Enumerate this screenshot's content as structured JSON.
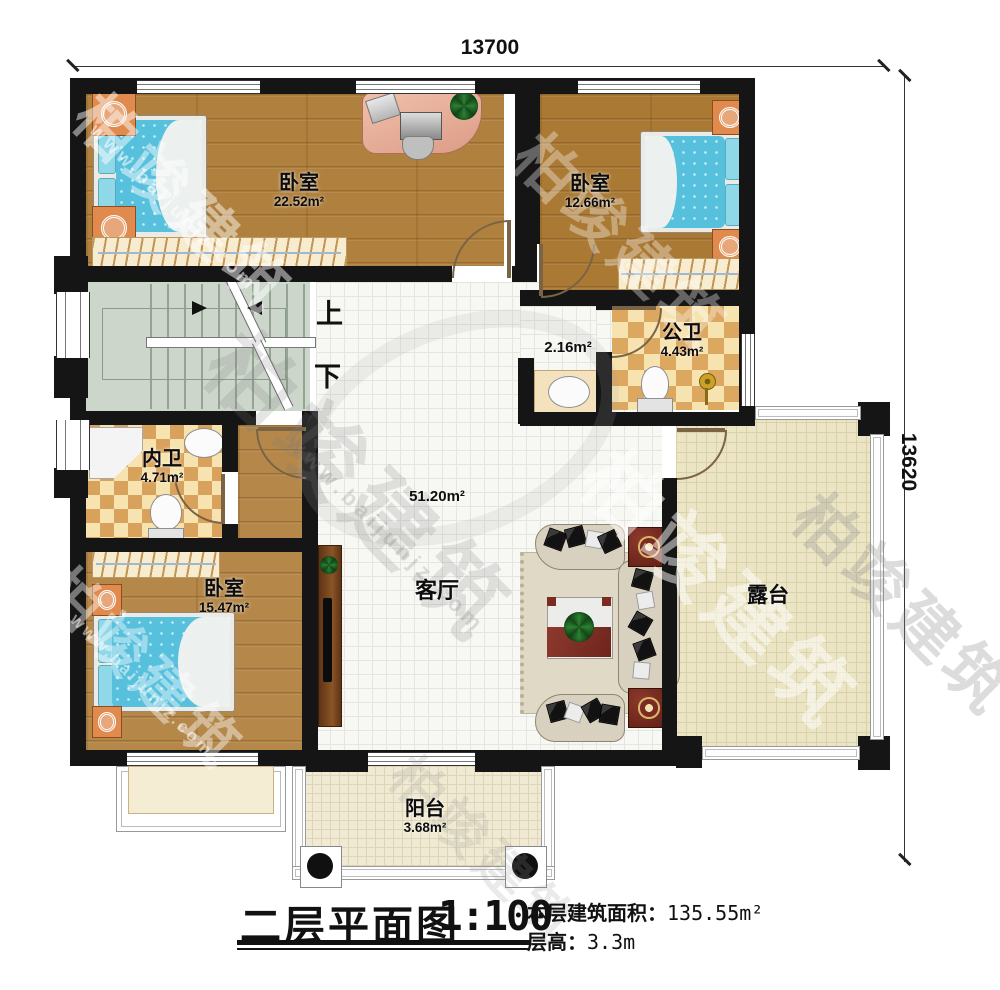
{
  "dimensions": {
    "top": "13700",
    "right": "13620"
  },
  "title": {
    "text": "二层平面图",
    "scale": "1:100"
  },
  "stats": {
    "floor_area_label": "本层建筑面积：",
    "floor_area_value": "135.55m²",
    "floor_height_label": "层高：",
    "floor_height_value": "3.3m"
  },
  "stairs": {
    "up": "上",
    "down": "下"
  },
  "rooms": {
    "bedroom_top_left": {
      "name": "卧室",
      "area": "22.52m²"
    },
    "bedroom_top_right": {
      "name": "卧室",
      "area": "12.66m²"
    },
    "bedroom_bottom_left": {
      "name": "卧室",
      "area": "15.47m²"
    },
    "public_bathroom": {
      "name": "公卫",
      "area": "4.43m²"
    },
    "private_bathroom": {
      "name": "内卫",
      "area": "4.71m²"
    },
    "hall_niche": {
      "area": "2.16m²"
    },
    "living_room": {
      "name": "客厅",
      "area": "51.20m²"
    },
    "terrace": {
      "name": "露台"
    },
    "balcony": {
      "name": "阳台",
      "area": "3.68m²"
    }
  },
  "watermark": {
    "brand": "柏竣建筑",
    "site": "www.baijunjz.com"
  },
  "colors": {
    "wall": "#151515",
    "wood_floor": "#b0813e",
    "bed": "#57c0dc",
    "bath_checker_light": "#f6e3b0",
    "bath_checker_dark": "#dca75f",
    "stairs": "#ccd6cb",
    "hall_tile": "#f7f7f4",
    "terrace": "#ebe5c6",
    "accent_table": "#7c2b22"
  }
}
